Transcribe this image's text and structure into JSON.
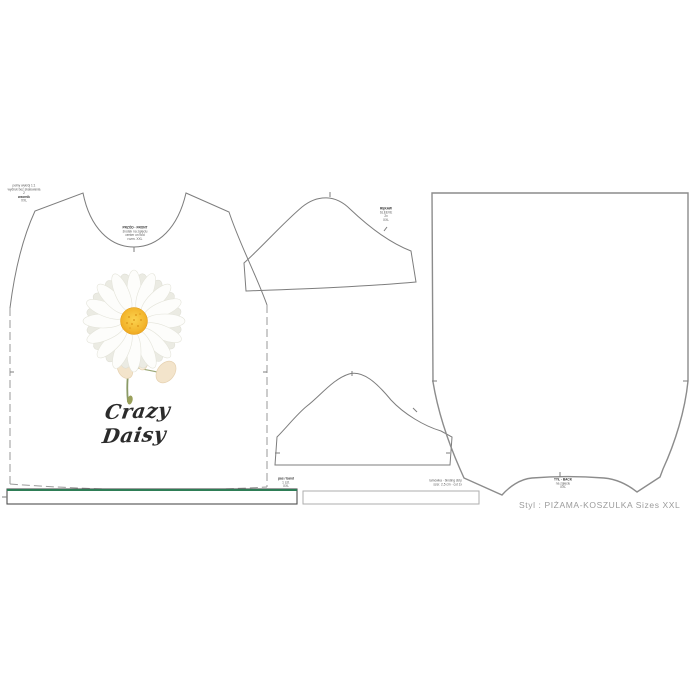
{
  "artwork": {
    "script_title": "Crazy Daisy"
  },
  "style_line": {
    "text": "Styl : PIŻAMA-KOSZULKA  Sizes XXL"
  },
  "microtext": {
    "corner_note": [
      "pełny wykrój 1:1",
      "wydruk bez skalowania",
      "2",
      "wzornik",
      "XXL"
    ],
    "front_label": [
      "PRZÓD · FRONT",
      "środek na zgięciu",
      "center on fold",
      "rozm. XXL"
    ],
    "sleeve_label": [
      "RĘKAW",
      "SLEEVE",
      "2x",
      "XXL"
    ],
    "back_label": [
      "TYŁ · BACK",
      "na zgięciu",
      "XXL"
    ],
    "band_label": [
      "pas / band",
      "1 szt.",
      "XXL"
    ],
    "binding_label": [
      "lamówka · binding strip",
      "szer. 2,5 cm · cut 1x"
    ]
  },
  "colors": {
    "band_accent_green": "#2e7d56",
    "piece_outline_gray": "#7d7d7d",
    "back_outline_gray": "#8c8c8c",
    "style_text_gray": "#9b9b9b",
    "daisy_center_orange": "#eda21b",
    "daisy_center_light": "#fbd24e",
    "stem_green": "#8a9a66",
    "bud_cream": "#f3e4cb",
    "script_ink": "#2b2b2b"
  },
  "icons": {
    "notch": "notch-tick",
    "fold": "fold-line-green"
  }
}
